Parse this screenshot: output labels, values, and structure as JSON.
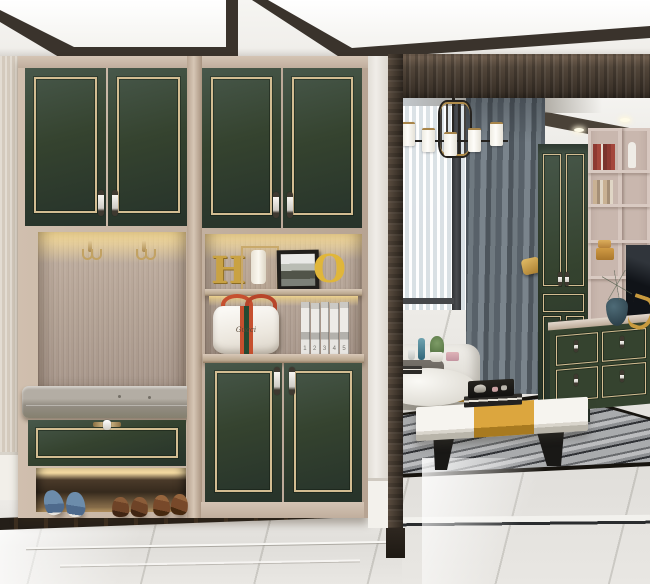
{
  "meta": {
    "type": "interior-photograph",
    "description": "Modern entry hall with forest-green shoe cabinets trimmed in champagne gold, a lit coat niche and bench, opening through a dark wood doorway to a living room with chandelier, gray curtains, green wardrobe, bookshelf, TV console and marble floors"
  },
  "palette": {
    "cabinet_green": "#35432f",
    "cabinet_green_dark": "#27332a",
    "trim_gold": "#d3bd92",
    "wood_light": "#d0bfae",
    "wood_medium": "#b7a493",
    "ceiling_trim_dark": "#3a332c",
    "doorway_wood": "#4e4338",
    "curtain_gray": "#5f6870",
    "sheer_white": "#eef1f3",
    "accent_mustard": "#d7a03a",
    "cushion_gray": "#9d968d",
    "floor_marble": "#e6e4e0",
    "floor_border_dark": "#241e18",
    "rug_marble_gray": "#a2a4a6",
    "handbag_stripe_red": "#c6502f",
    "handbag_stripe_green": "#254a32",
    "niche_glow": "#ffe296"
  },
  "entry": {
    "decor": {
      "letter_h": "H",
      "letter_o": "O"
    },
    "handbag": {
      "monogram": "Gucci"
    },
    "shelf_books": {
      "volumes": [
        "1",
        "2",
        "3",
        "4",
        "5"
      ]
    },
    "items": [
      "upper wall cabinets",
      "coat hooks",
      "display niche",
      "table lamp",
      "photo frame",
      "handbag",
      "book set",
      "bench cushion",
      "shoe drawer",
      "blue sneakers",
      "brown loafers",
      "lower cabinets"
    ]
  },
  "living_room": {
    "items": [
      "chandelier",
      "recessed downlights",
      "sheer curtain",
      "gray curtain with gold tieback",
      "window",
      "black armchair",
      "white sofa",
      "round side table",
      "coffee table with tea tray and books",
      "area rug inlay",
      "green wardrobe",
      "bookshelf",
      "tv screen",
      "green tv console",
      "marble floor"
    ]
  }
}
